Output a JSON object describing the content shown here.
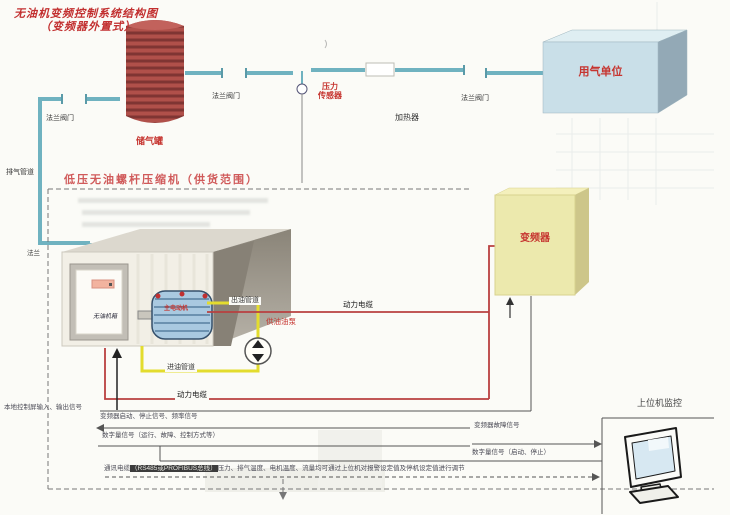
{
  "title": {
    "line1": "无油机变频控制系统结构图",
    "line2": "（变频器外置式）"
  },
  "tank": {
    "label": "储气罐"
  },
  "pipes": {
    "exhaust": "排气管道",
    "flange_short": "法兰",
    "flange_valve": "法兰阀门"
  },
  "sensor": {
    "line1": "压力",
    "line2": "传感器"
  },
  "heater": {
    "label": "加热器"
  },
  "gas_unit": {
    "label": "用气单位"
  },
  "supply_scope": {
    "heading": "低压无油螺杆压缩机（供货范围）"
  },
  "compressor": {
    "cabinet_label": "无油机箱",
    "motor_label": "主电动机",
    "pump_label": "供油油泵",
    "oil_out": "出油管道",
    "oil_in": "进油管道"
  },
  "vfd": {
    "label": "变频器"
  },
  "cables": {
    "power": "动力电缆"
  },
  "signals": {
    "local_io": "本地控制屏输入、输出信号",
    "vfd_control": "变频器启动、停止信号、频率信号",
    "vfd_fault": "变频器故障信号",
    "digital_run": "数字量信号（运行、故障、控制方式等）",
    "digital_start": "数字量信号（启动、停止）"
  },
  "comm": {
    "prefix": "通讯电缆",
    "highlight": "（RS485或PROFIBUS总线）",
    "rest": "压力、排气温度、电机温度、流量均可通过上位机对报警设定值及停机设定值进行调节"
  },
  "host": {
    "label": "上位机监控"
  },
  "colors": {
    "pipe": "#6fb2c0",
    "oil_line": "#e3dc2e",
    "power_cable": "#b94040",
    "accent_red": "#cc3333",
    "tank_red": "#b0504a",
    "vfd_yellow": "#ece9ad",
    "gas_unit_blue": "#c9dfe8"
  }
}
